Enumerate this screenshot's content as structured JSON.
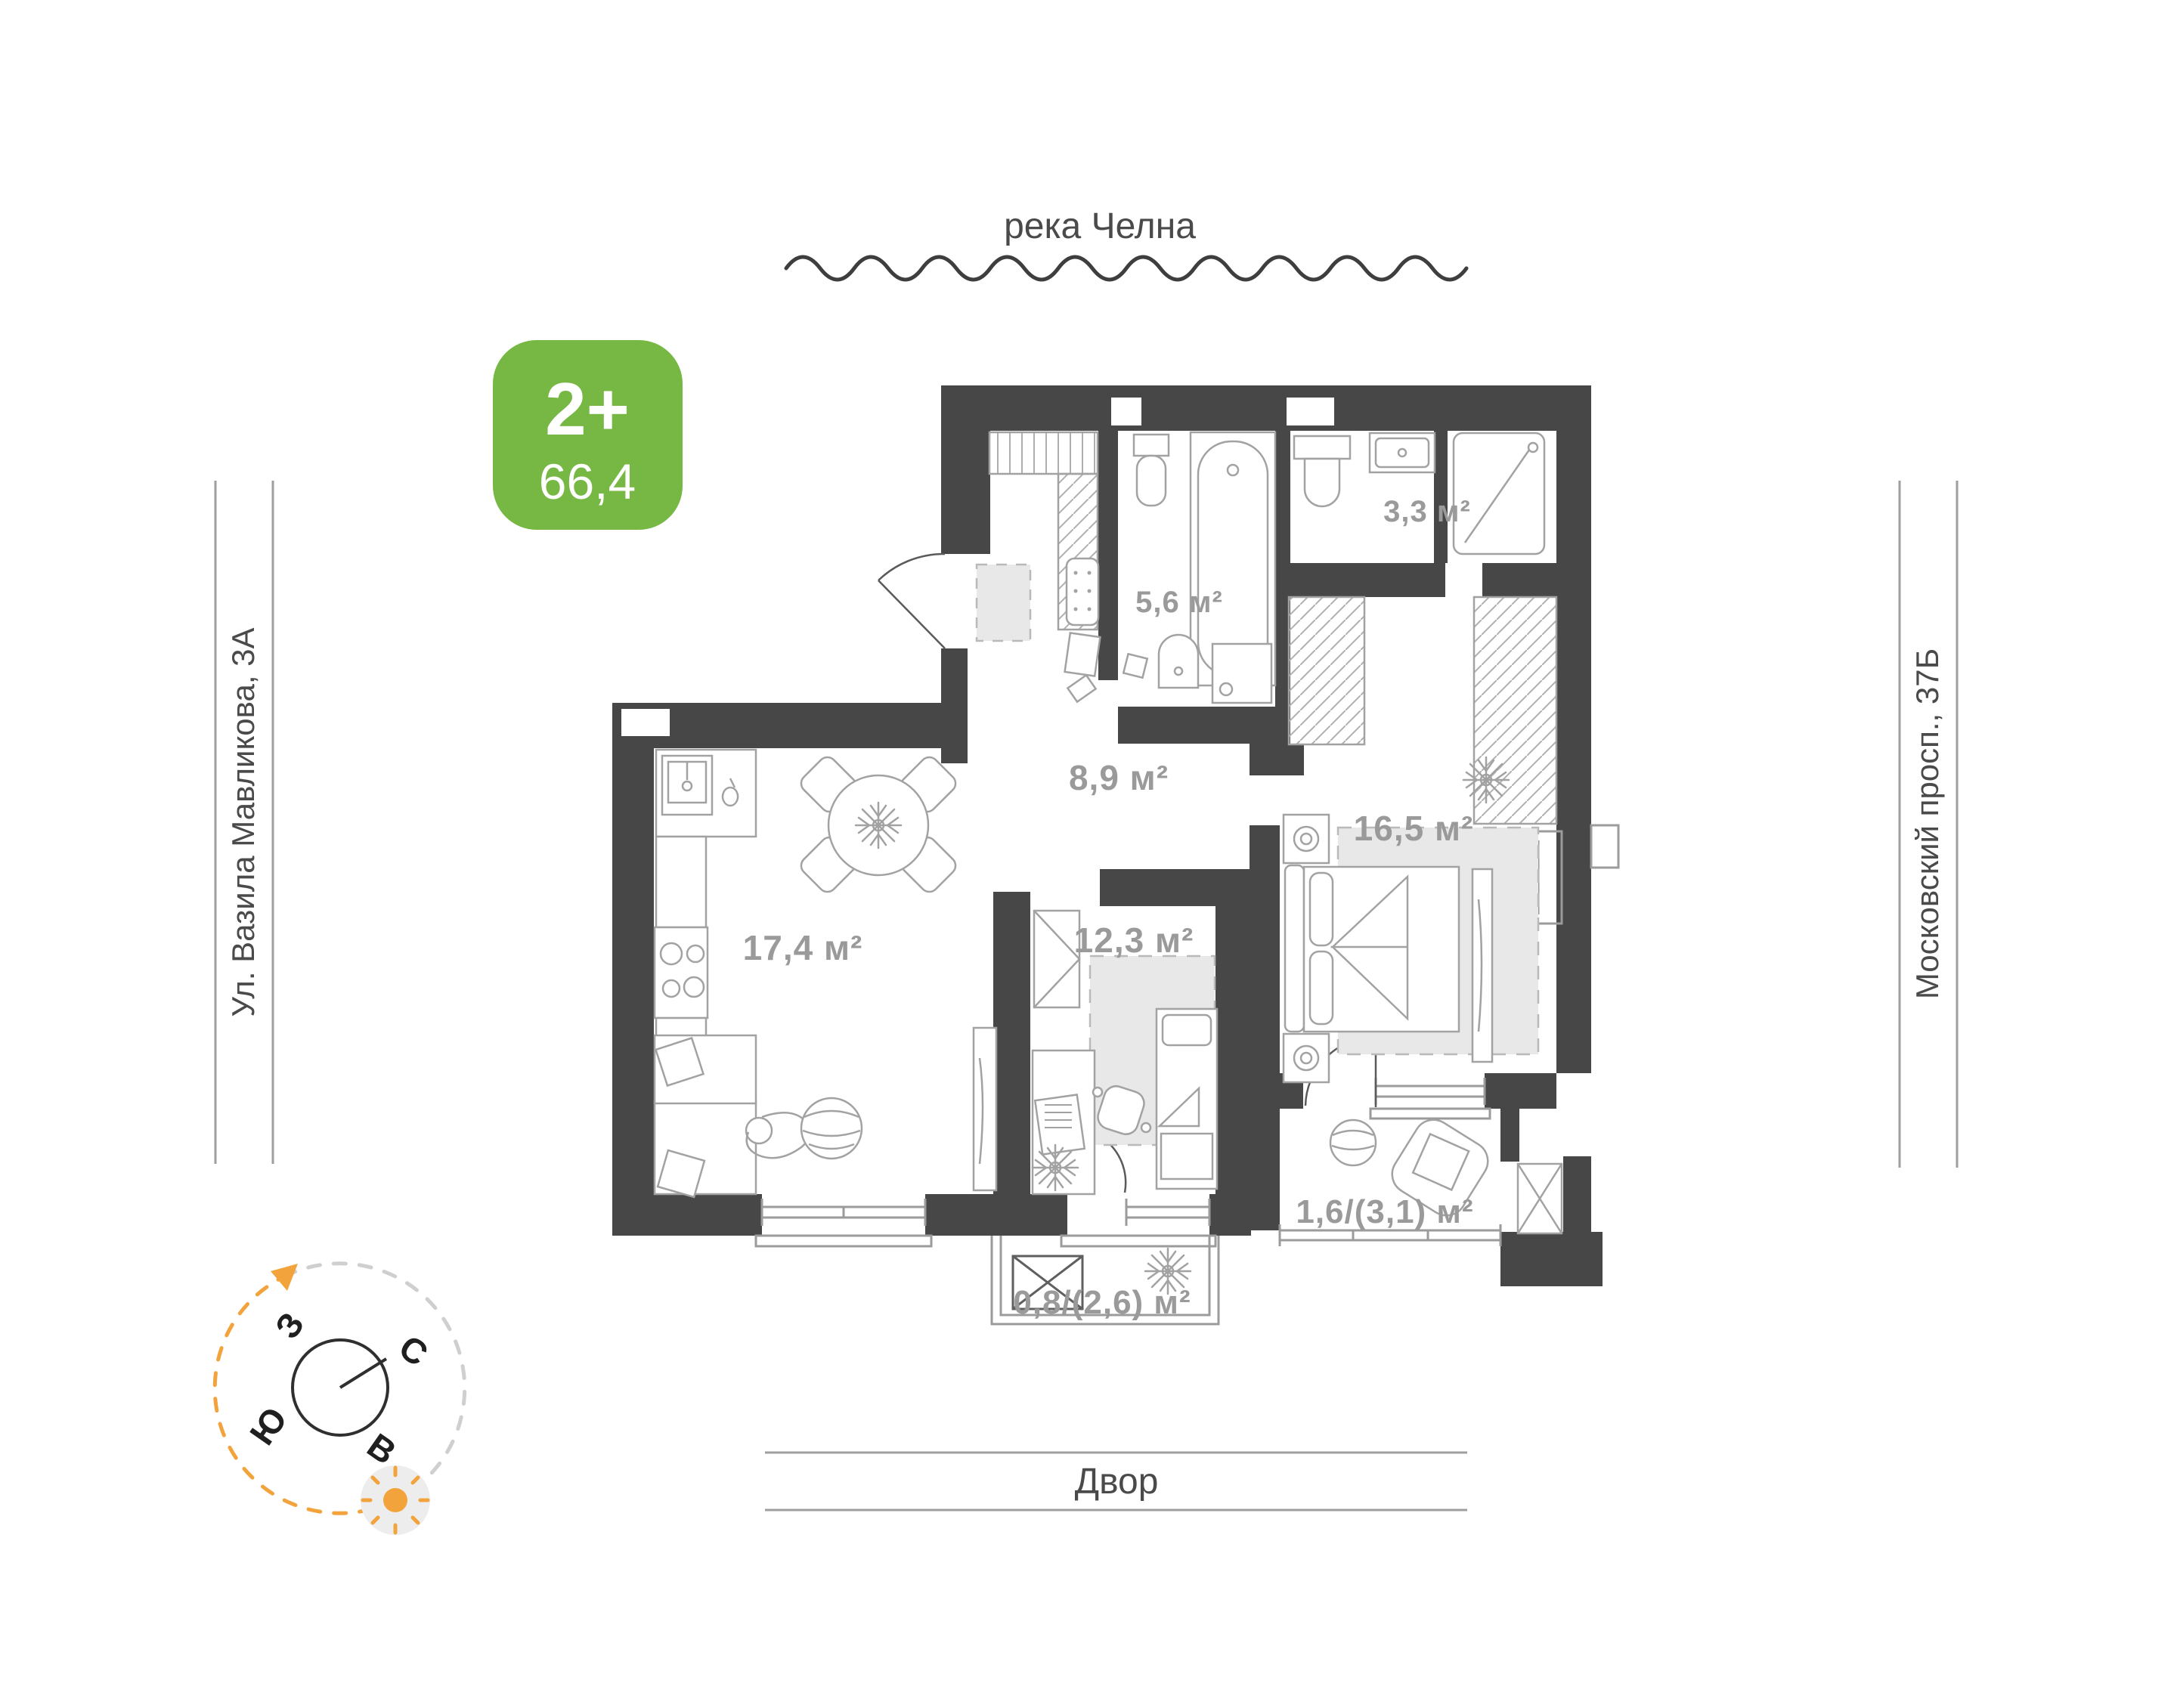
{
  "environment": {
    "river": "река Челна",
    "street_left": "Ул. Вазила Мавликова, 3А",
    "street_right": "Московский просп., 37Б",
    "courtyard": "Двор"
  },
  "badge": {
    "room_type": "2+",
    "total_area": "66,4"
  },
  "rooms": [
    {
      "id": "kitchen_living",
      "area_label": "17,4 м²"
    },
    {
      "id": "hallway",
      "area_label": "8,9 м²"
    },
    {
      "id": "bathroom",
      "area_label": "5,6 м²"
    },
    {
      "id": "wc",
      "area_label": "3,3 м²"
    },
    {
      "id": "bedroom",
      "area_label": "16,5 м²"
    },
    {
      "id": "room",
      "area_label": "12,3 м²"
    },
    {
      "id": "loggia",
      "area_label": "1,6/(3,1) м²"
    },
    {
      "id": "balcony",
      "area_label": "0,8/(2,6) м²"
    }
  ],
  "compass": {
    "west": "З",
    "north": "С",
    "south": "Ю",
    "east": "В"
  },
  "colors": {
    "wall": "#474747",
    "badge_green": "#76B843",
    "room_label": "#9a9a9a",
    "furniture_line": "#a2a2a2",
    "carpet": "#e8e8e8",
    "accent_orange": "#F2A33C",
    "outside_text": "#4a4a4a",
    "guide_line": "#9e9e9e"
  }
}
